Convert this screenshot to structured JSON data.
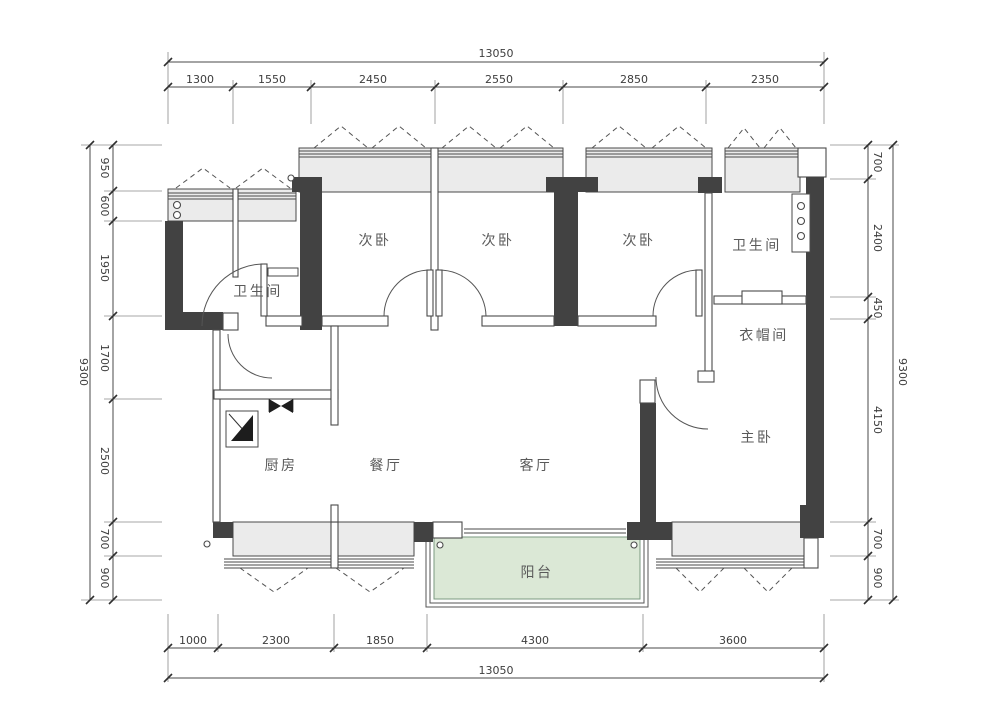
{
  "plan": {
    "rooms": {
      "bath1": "卫生间",
      "bed1": "次卧",
      "bed2": "次卧",
      "bed3": "次卧",
      "bath2": "卫生间",
      "cloak": "衣帽间",
      "master": "主卧",
      "kitchen": "厨房",
      "dining": "餐厅",
      "living": "客厅",
      "balcony": "阳台"
    },
    "colors": {
      "wall_dark": "#424242",
      "window_fill": "#ebebeb",
      "balcony_fill": "#dbe8d6",
      "balcony_text": "#7da183",
      "room_text": "#5a5a5a"
    }
  },
  "dims": {
    "top": {
      "total": "13050",
      "segments": [
        "1300",
        "1550",
        "2450",
        "2550",
        "2850",
        "2350"
      ]
    },
    "bottom": {
      "total": "13050",
      "segments": [
        "1000",
        "2300",
        "1850",
        "4300",
        "3600"
      ]
    },
    "left": {
      "total": "9300",
      "segments": [
        "950",
        "600",
        "1950",
        "1700",
        "2500",
        "700",
        "900"
      ]
    },
    "right": {
      "total": "9300",
      "segments": [
        "700",
        "2400",
        "450",
        "4150",
        "700",
        "900"
      ]
    }
  }
}
